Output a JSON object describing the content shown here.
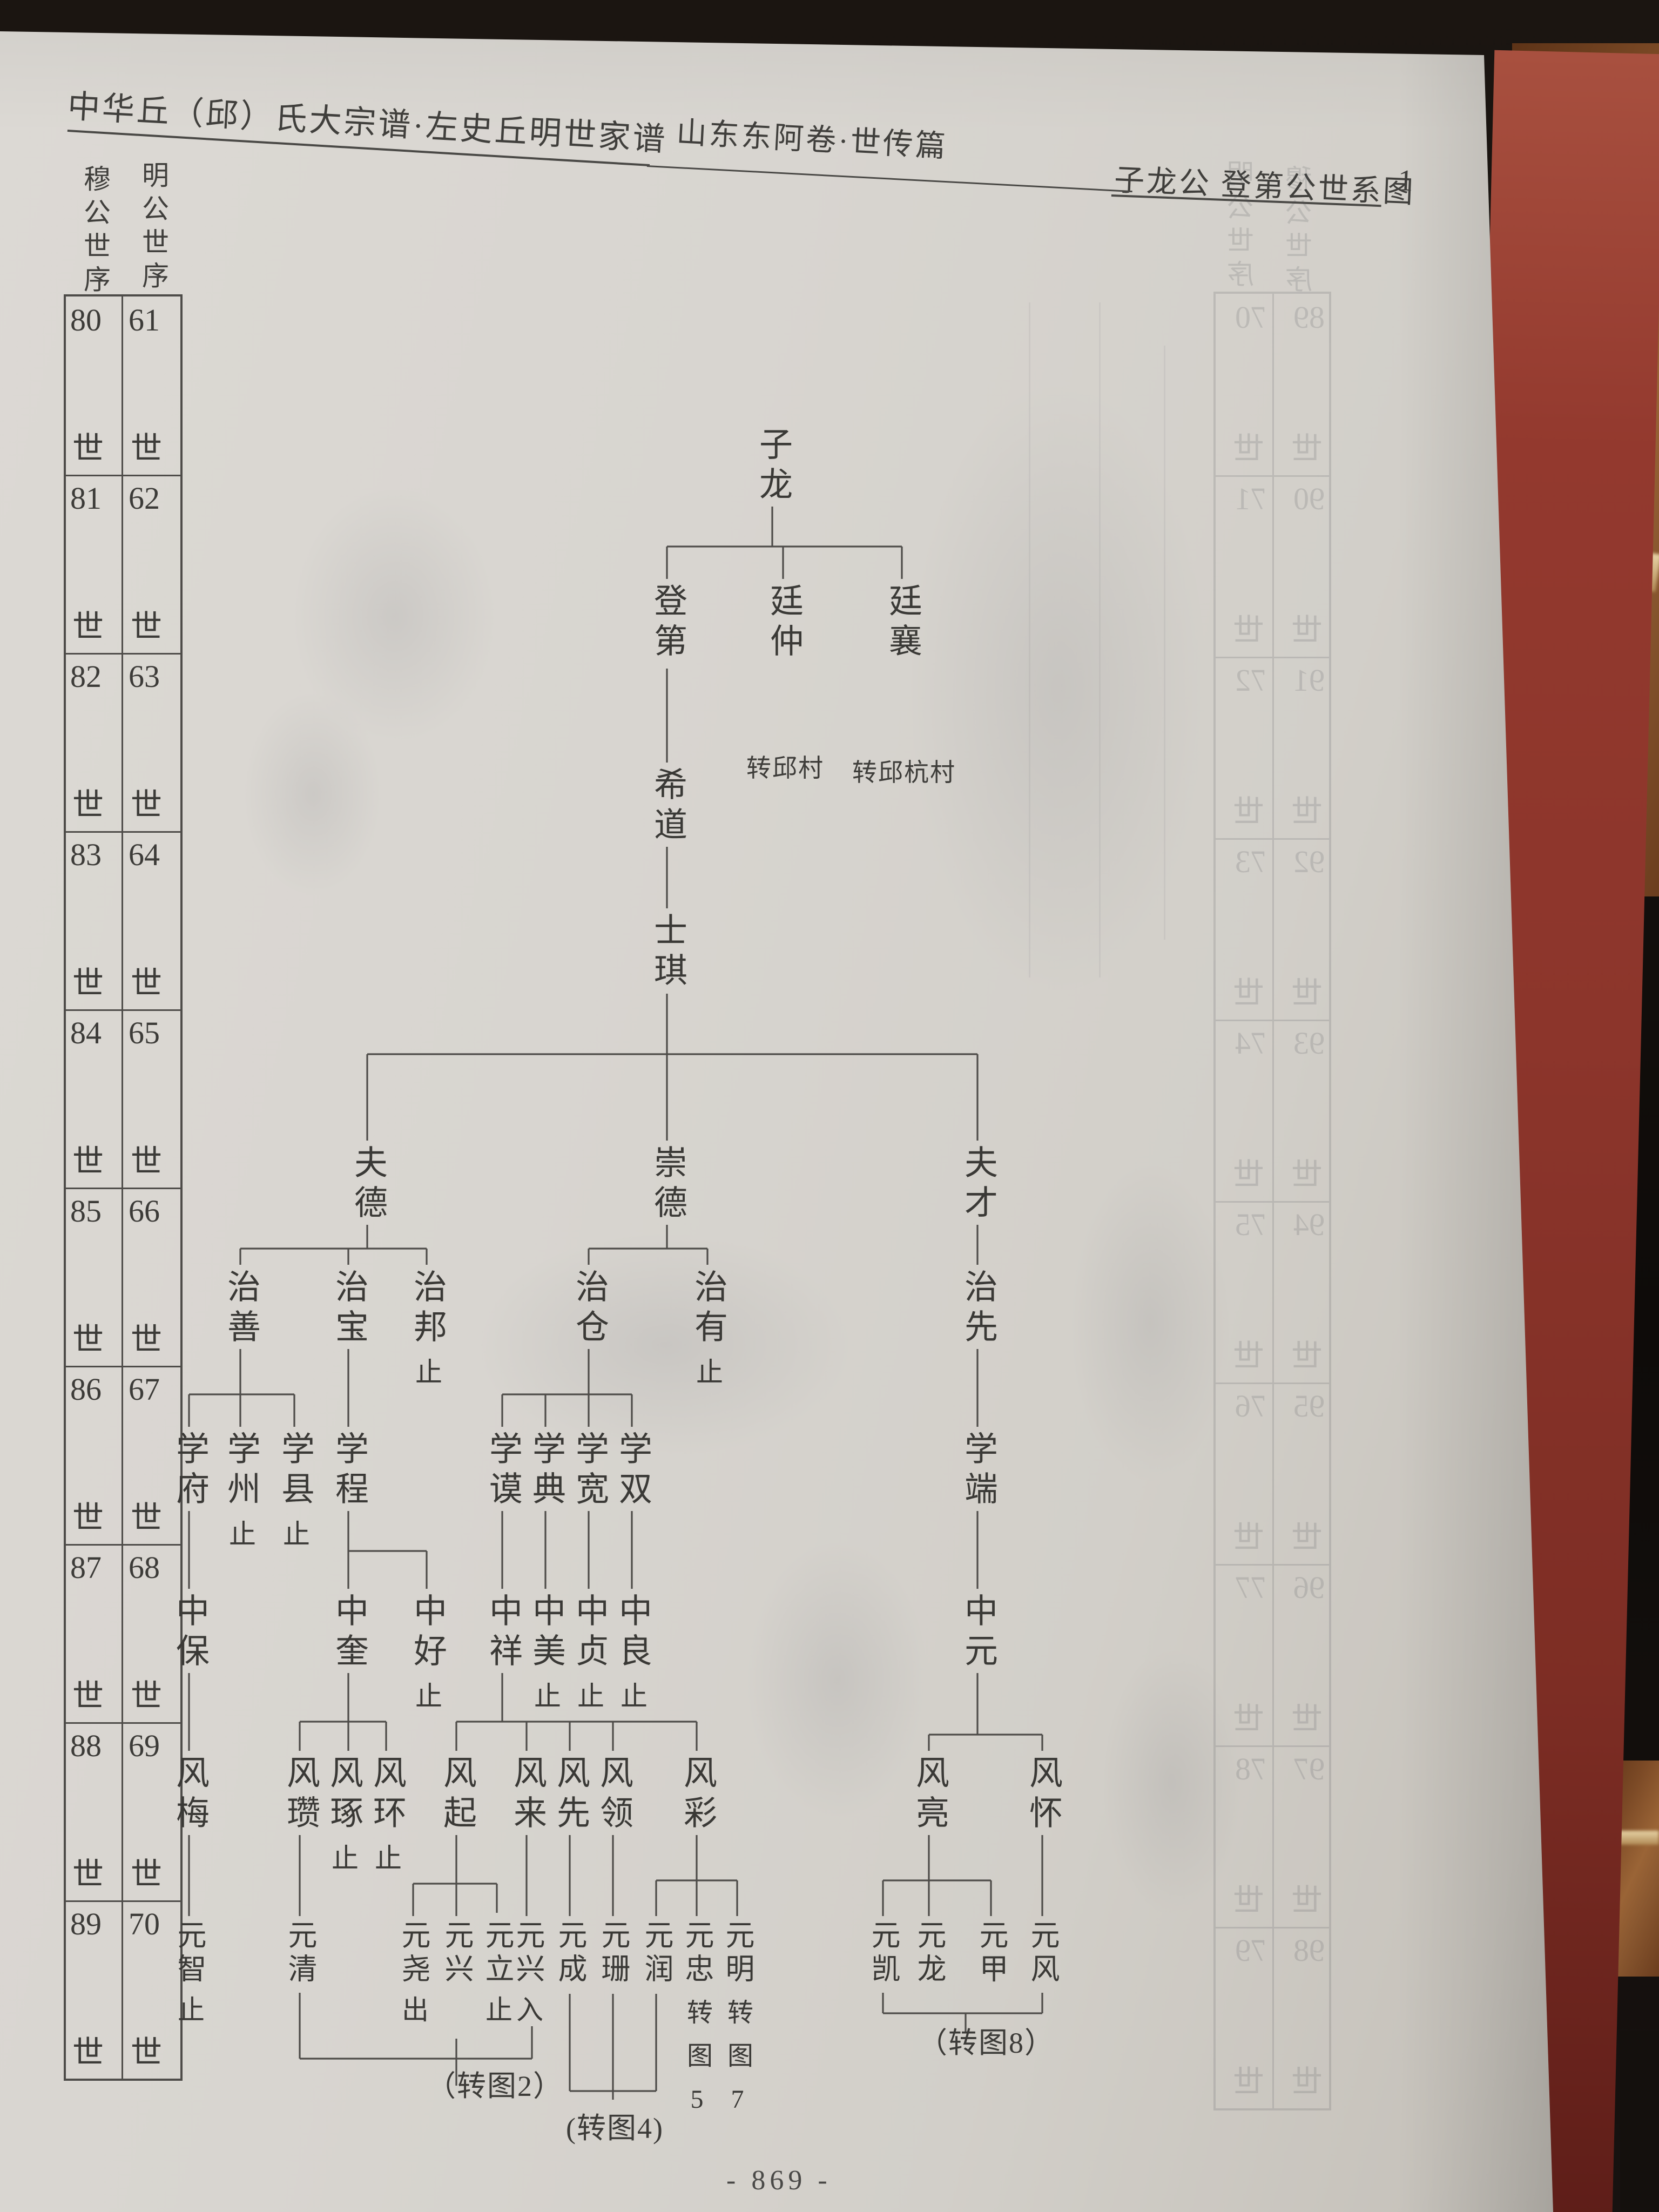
{
  "header": {
    "left_title": "中华丘（邱）氏大宗谱·左史丘明世家谱",
    "center_title": "山东东阿卷·世传篇",
    "right_title": "子龙公 登第公世系图",
    "right_page_no": "1"
  },
  "generation_table": {
    "left_header": "穆公世序",
    "right_header": "明公世序",
    "shi": "世",
    "rows": [
      {
        "mu": "80",
        "ming": "61"
      },
      {
        "mu": "81",
        "ming": "62"
      },
      {
        "mu": "82",
        "ming": "63"
      },
      {
        "mu": "83",
        "ming": "64"
      },
      {
        "mu": "84",
        "ming": "65"
      },
      {
        "mu": "85",
        "ming": "66"
      },
      {
        "mu": "86",
        "ming": "67"
      },
      {
        "mu": "87",
        "ming": "68"
      },
      {
        "mu": "88",
        "ming": "69"
      },
      {
        "mu": "89",
        "ming": "70"
      }
    ]
  },
  "tree": {
    "nodes": [
      {
        "label": "子龙"
      },
      {
        "label": "登第"
      },
      {
        "label": "廷仲",
        "note": "转邱村"
      },
      {
        "label": "廷襄",
        "note": "转邱杭村"
      },
      {
        "label": "希道"
      },
      {
        "label": "士琪"
      },
      {
        "label": "夫德"
      },
      {
        "label": "崇德"
      },
      {
        "label": "夫才"
      },
      {
        "label": "治善"
      },
      {
        "label": "治宝"
      },
      {
        "label": "治邦",
        "mark": "止"
      },
      {
        "label": "治仓"
      },
      {
        "label": "治有",
        "mark": "止"
      },
      {
        "label": "治先"
      },
      {
        "label": "学府"
      },
      {
        "label": "学州",
        "mark": "止"
      },
      {
        "label": "学县",
        "mark": "止"
      },
      {
        "label": "学程"
      },
      {
        "label": "学谟"
      },
      {
        "label": "学典"
      },
      {
        "label": "学宽"
      },
      {
        "label": "学双"
      },
      {
        "label": "学端"
      },
      {
        "label": "中保"
      },
      {
        "label": "中奎"
      },
      {
        "label": "中好",
        "mark": "止"
      },
      {
        "label": "中祥"
      },
      {
        "label": "中美",
        "mark": "止"
      },
      {
        "label": "中贞",
        "mark": "止"
      },
      {
        "label": "中良",
        "mark": "止"
      },
      {
        "label": "中元"
      },
      {
        "label": "风梅"
      },
      {
        "label": "风瓒"
      },
      {
        "label": "风琢",
        "mark": "止"
      },
      {
        "label": "风环",
        "mark": "止"
      },
      {
        "label": "风起"
      },
      {
        "label": "风来"
      },
      {
        "label": "风先"
      },
      {
        "label": "风领"
      },
      {
        "label": "风彩"
      },
      {
        "label": "风亮"
      },
      {
        "label": "风怀"
      },
      {
        "label": "元智",
        "mark": "止"
      },
      {
        "label": "元清"
      },
      {
        "label": "元尧",
        "mark": "出"
      },
      {
        "label": "元兴"
      },
      {
        "label": "元立",
        "mark": "止"
      },
      {
        "label": "元兴",
        "mark": "入"
      },
      {
        "label": "元成"
      },
      {
        "label": "元珊"
      },
      {
        "label": "元润"
      },
      {
        "label": "元忠",
        "mark": "转图5"
      },
      {
        "label": "元明",
        "mark": "转图7"
      },
      {
        "label": "元凯"
      },
      {
        "label": "元龙"
      },
      {
        "label": "元甲"
      },
      {
        "label": "元风"
      }
    ]
  },
  "annotations": {
    "to_chart_2": "（转图2）",
    "to_chart_4": "(转图4)",
    "to_chart_8": "（转图8）"
  },
  "footer": {
    "page_number": "- 869 -"
  },
  "ghost_table": {
    "left_header": "穆公世序",
    "right_header": "明公世序",
    "shi": "世",
    "rows": [
      {
        "mu": "89",
        "ming": "70"
      },
      {
        "mu": "90",
        "ming": "71"
      },
      {
        "mu": "91",
        "ming": "72"
      },
      {
        "mu": "92",
        "ming": "73"
      },
      {
        "mu": "93",
        "ming": "74"
      },
      {
        "mu": "94",
        "ming": "75"
      },
      {
        "mu": "95",
        "ming": "76"
      },
      {
        "mu": "96",
        "ming": "77"
      },
      {
        "mu": "97",
        "ming": "78"
      },
      {
        "mu": "98",
        "ming": "79"
      }
    ]
  }
}
